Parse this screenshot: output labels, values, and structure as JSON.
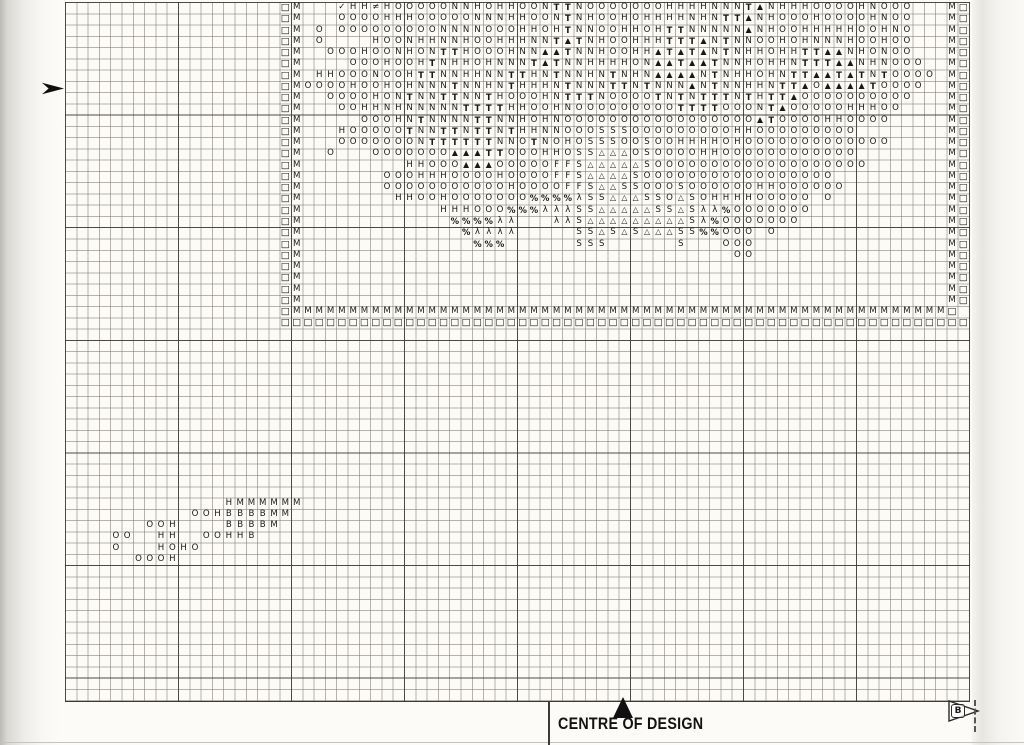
{
  "page": {
    "centre_label": "CENTRE OF DESIGN",
    "page_flag_letter": "B"
  },
  "chart": {
    "grid_columns": 80,
    "grid_rows": 62,
    "symbols_used": [
      "O",
      "H",
      "N",
      "T",
      "M",
      "B",
      "S",
      "F",
      "▲",
      "△",
      "□",
      "✓",
      "≠",
      "%",
      "λ"
    ],
    "motif": {
      "origin_col": 19,
      "origin_row": 0,
      "rows": [
        "□M   ✓HH≠HOOOOONNHOHHOONTTNOOOOOOOHHHHNNNT▲NHHHOOOOHNOOO   M□",
        "□M   OOOOHHHOOOOONNNHHOONTNHOOHOHHHHNHNTT▲NHOOOHOOOOHNOO   M□",
        "□M O OOOOOOOOONNNNOOOHHOHTNNOOHHOHTTNNNNN▲NHOOHHHHHOOHNO   M□",
        "□M O    HOONHHNNHOOHHHNNT▲TNHOOHHHTTT▲NTNNOOHOHNNNHOOHOO   M□",
        "□M  OOOHOONHONTTHOOOHNN▲▲TNNHOOHH▲T▲T▲NTNHHOHHTT▲▲NHONOO   M□",
        "□M    OOOHOOHTNHHOHNNNT▲TNNHHHHON▲▲T▲▲TNNHOHHNTTT▲▲NHNOOO  M□",
        "□M HHOOONOOHTTNNHHNNTTHNTNNHNTNHN▲▲▲▲NTNHHOHNTT▲▲T▲TNTOOOO M□",
        "□MOOOOHOOHOHNNNTNNHNTHHHNTNNNTTNTNNN▲NTNNHHNTT▲O▲▲▲▲TOOOO  M□",
        "□M  OOOOHONTNNTTNNTHOOOHNTTTNOOOOTNTNTTTNTHTT▲OOOOOOOOOO   M□",
        "□M   OOHHNHNNNNNTTTTHHOOHNOOOOOOOOOTTTTOOONT▲OOOOOHHHOO    M□",
        "□M     OOOHNTNNNNTTNNHOHNOOOOOOOOOOOOOOOOO▲TOOOOHHOOOO     M□",
        "□M   HOOOOOTNNTTNTTNTHHNNOOOSSSOOOOOOOOOHHOOOOOOOOO        M□",
        "□M   OOOOOOONTTTTTTNNOTNOHOSSSOOSOOHHHHOHOOOOOOOOOOOOO     M□",
        "□M  O   OOOOOOO▲▲▲TTOOOHHOSS△△△OSOOOOHHOOOOOOOOOOOO        M□",
        "□M         HHOOO▲▲▲OOOOOFFS△△△△△SOOOOOOOOOOOOOOOOOOO       M□",
        "□M       OOOHHHOOOOHOOOOFFS△△△△SOOOOOOOOOOOOOOOOO          M□",
        "□M       OOOOOOOOOOOHOOOOFFS△△SSOOOSOOOOOOHHOOOOOO         M□",
        "□M        HHOOHOOOOOOO%%%%λSS△△△SSO△SOHHHHOOOOO O          M□",
        "□M            HHHOOO%%%λλλSS△△△△△SS△Sλλ%OOOOOOO            M□",
        "□M             %%%%λλ   λλS△△△△△△△△△Sλ%OOOOOOO             M□",
        "□M              %λλλλ     SS△S△S△△△SS%%OOO O               M□",
        "□M               %%%      SSS      S   OOO                 M□",
        "□M                                      OO                 M□",
        "□M                                                         M□",
        "□M                                                         M□",
        "□M                                                         M□",
        "□M                                                         M□",
        "□MMMMMMMMMMMMMMMMMMMMMMMMMMMMMMMMMMMMMMMMMMMMMMMMMMMMMMMMMM□",
        "□□□□□□□□□□□□□□□□□□□□□□□□□□□□□□□□□□□□□□□□□□□□□□□□□□□□□□□□□□□□□"
      ]
    },
    "cluster": {
      "origin_col": 4,
      "origin_row": 44,
      "rows": [
        "          HMMMMMM",
        "       OOHBBBBMM ",
        "   OOH    BBBBM  ",
        "OO  HH  OOHHB    ",
        "O   HOHO         ",
        "  OOOH           "
      ]
    }
  }
}
